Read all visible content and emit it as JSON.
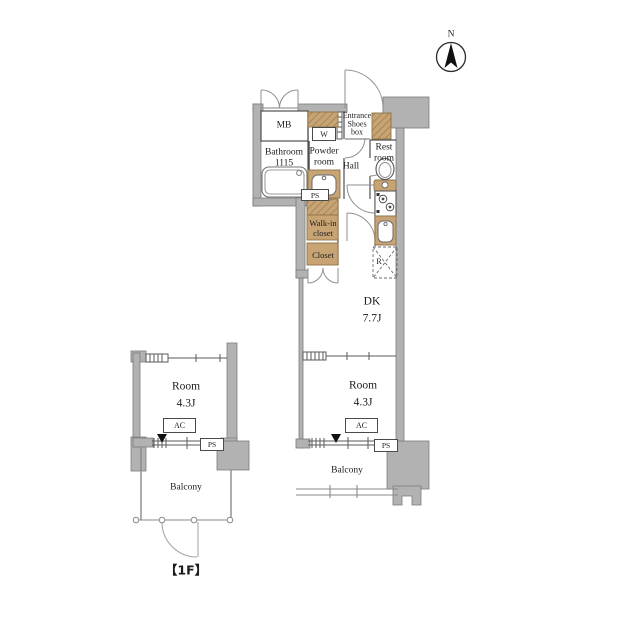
{
  "compass": {
    "north_label": "N"
  },
  "floor_label": "【1F】",
  "rooms": {
    "mb": "MB",
    "entrance": "Entrance",
    "shoes_box": "Shoes\nbox",
    "bathroom": "Bathroom\n1115",
    "powder_room": "Powder\nroom",
    "hall": "Hall",
    "rest_room": "Rest\nroom",
    "walk_in_closet": "Walk-in\ncloset",
    "closet": "Closet",
    "dk": "DK\n7.7J",
    "room_right": "Room\n4.3J",
    "room_left": "Room\n4.3J",
    "balcony_right": "Balcony",
    "balcony_left": "Balcony"
  },
  "labels": {
    "ps": "PS",
    "ac": "AC",
    "washer": "W",
    "refrigerator": "R"
  },
  "colors": {
    "background": "#ffffff",
    "wall_gray": "#b2b2b2",
    "fixture_tan": "#c8a475",
    "line_dark": "#4a4a4a"
  }
}
